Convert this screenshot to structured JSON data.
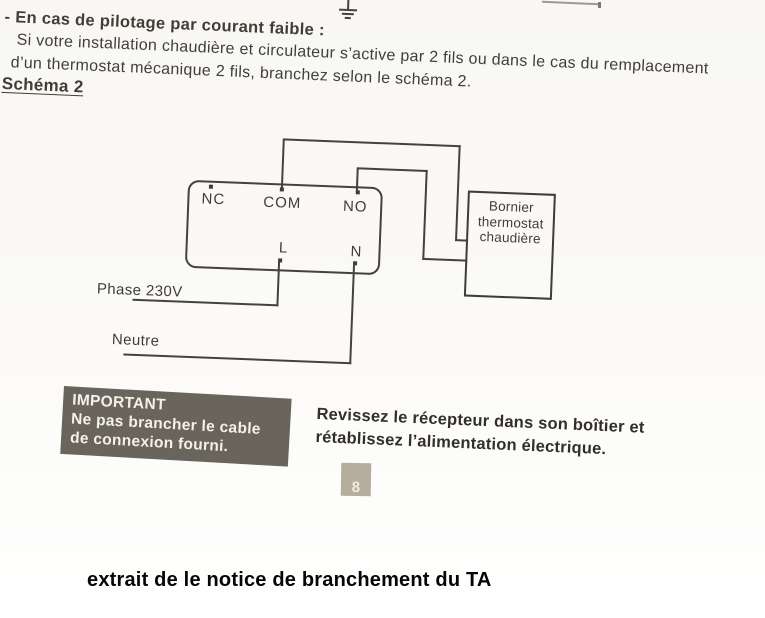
{
  "header": {
    "title": "- En cas de pilotage par courant faible :",
    "line1": "Si votre installation chaudière et circulateur s’active par 2 fils ou dans le cas du remplacement",
    "line2": "d’un thermostat mécanique 2 fils, branchez selon le schéma 2.",
    "schema_label": "Schéma 2"
  },
  "diagram": {
    "terminals": {
      "nc": "NC",
      "com": "COM",
      "no": "NO",
      "l": "L",
      "n": "N"
    },
    "bornier": {
      "line1": "Bornier",
      "line2": "thermostat",
      "line3": "chaudière"
    },
    "phase_label": "Phase 230V",
    "neutre_label": "Neutre",
    "ground_symbol": "earth-ground"
  },
  "important": {
    "title": "IMPORTANT",
    "line1": "Ne pas brancher le cable",
    "line2": "de connexion fourni.",
    "bg_color": "#69655c"
  },
  "instruction": {
    "line1": "Revissez le récepteur dans son boîtier et",
    "line2": "rétablissez l’alimentation électrique."
  },
  "page_number": "8",
  "caption": "extrait de le notice de branchement du TA",
  "colors": {
    "wire": "#45423c",
    "scan_text": "#413e37",
    "important_bg": "#69655c",
    "important_text": "#f3f1ea",
    "page_number_bg": "#b5ae9f",
    "caption_text": "#060606"
  }
}
